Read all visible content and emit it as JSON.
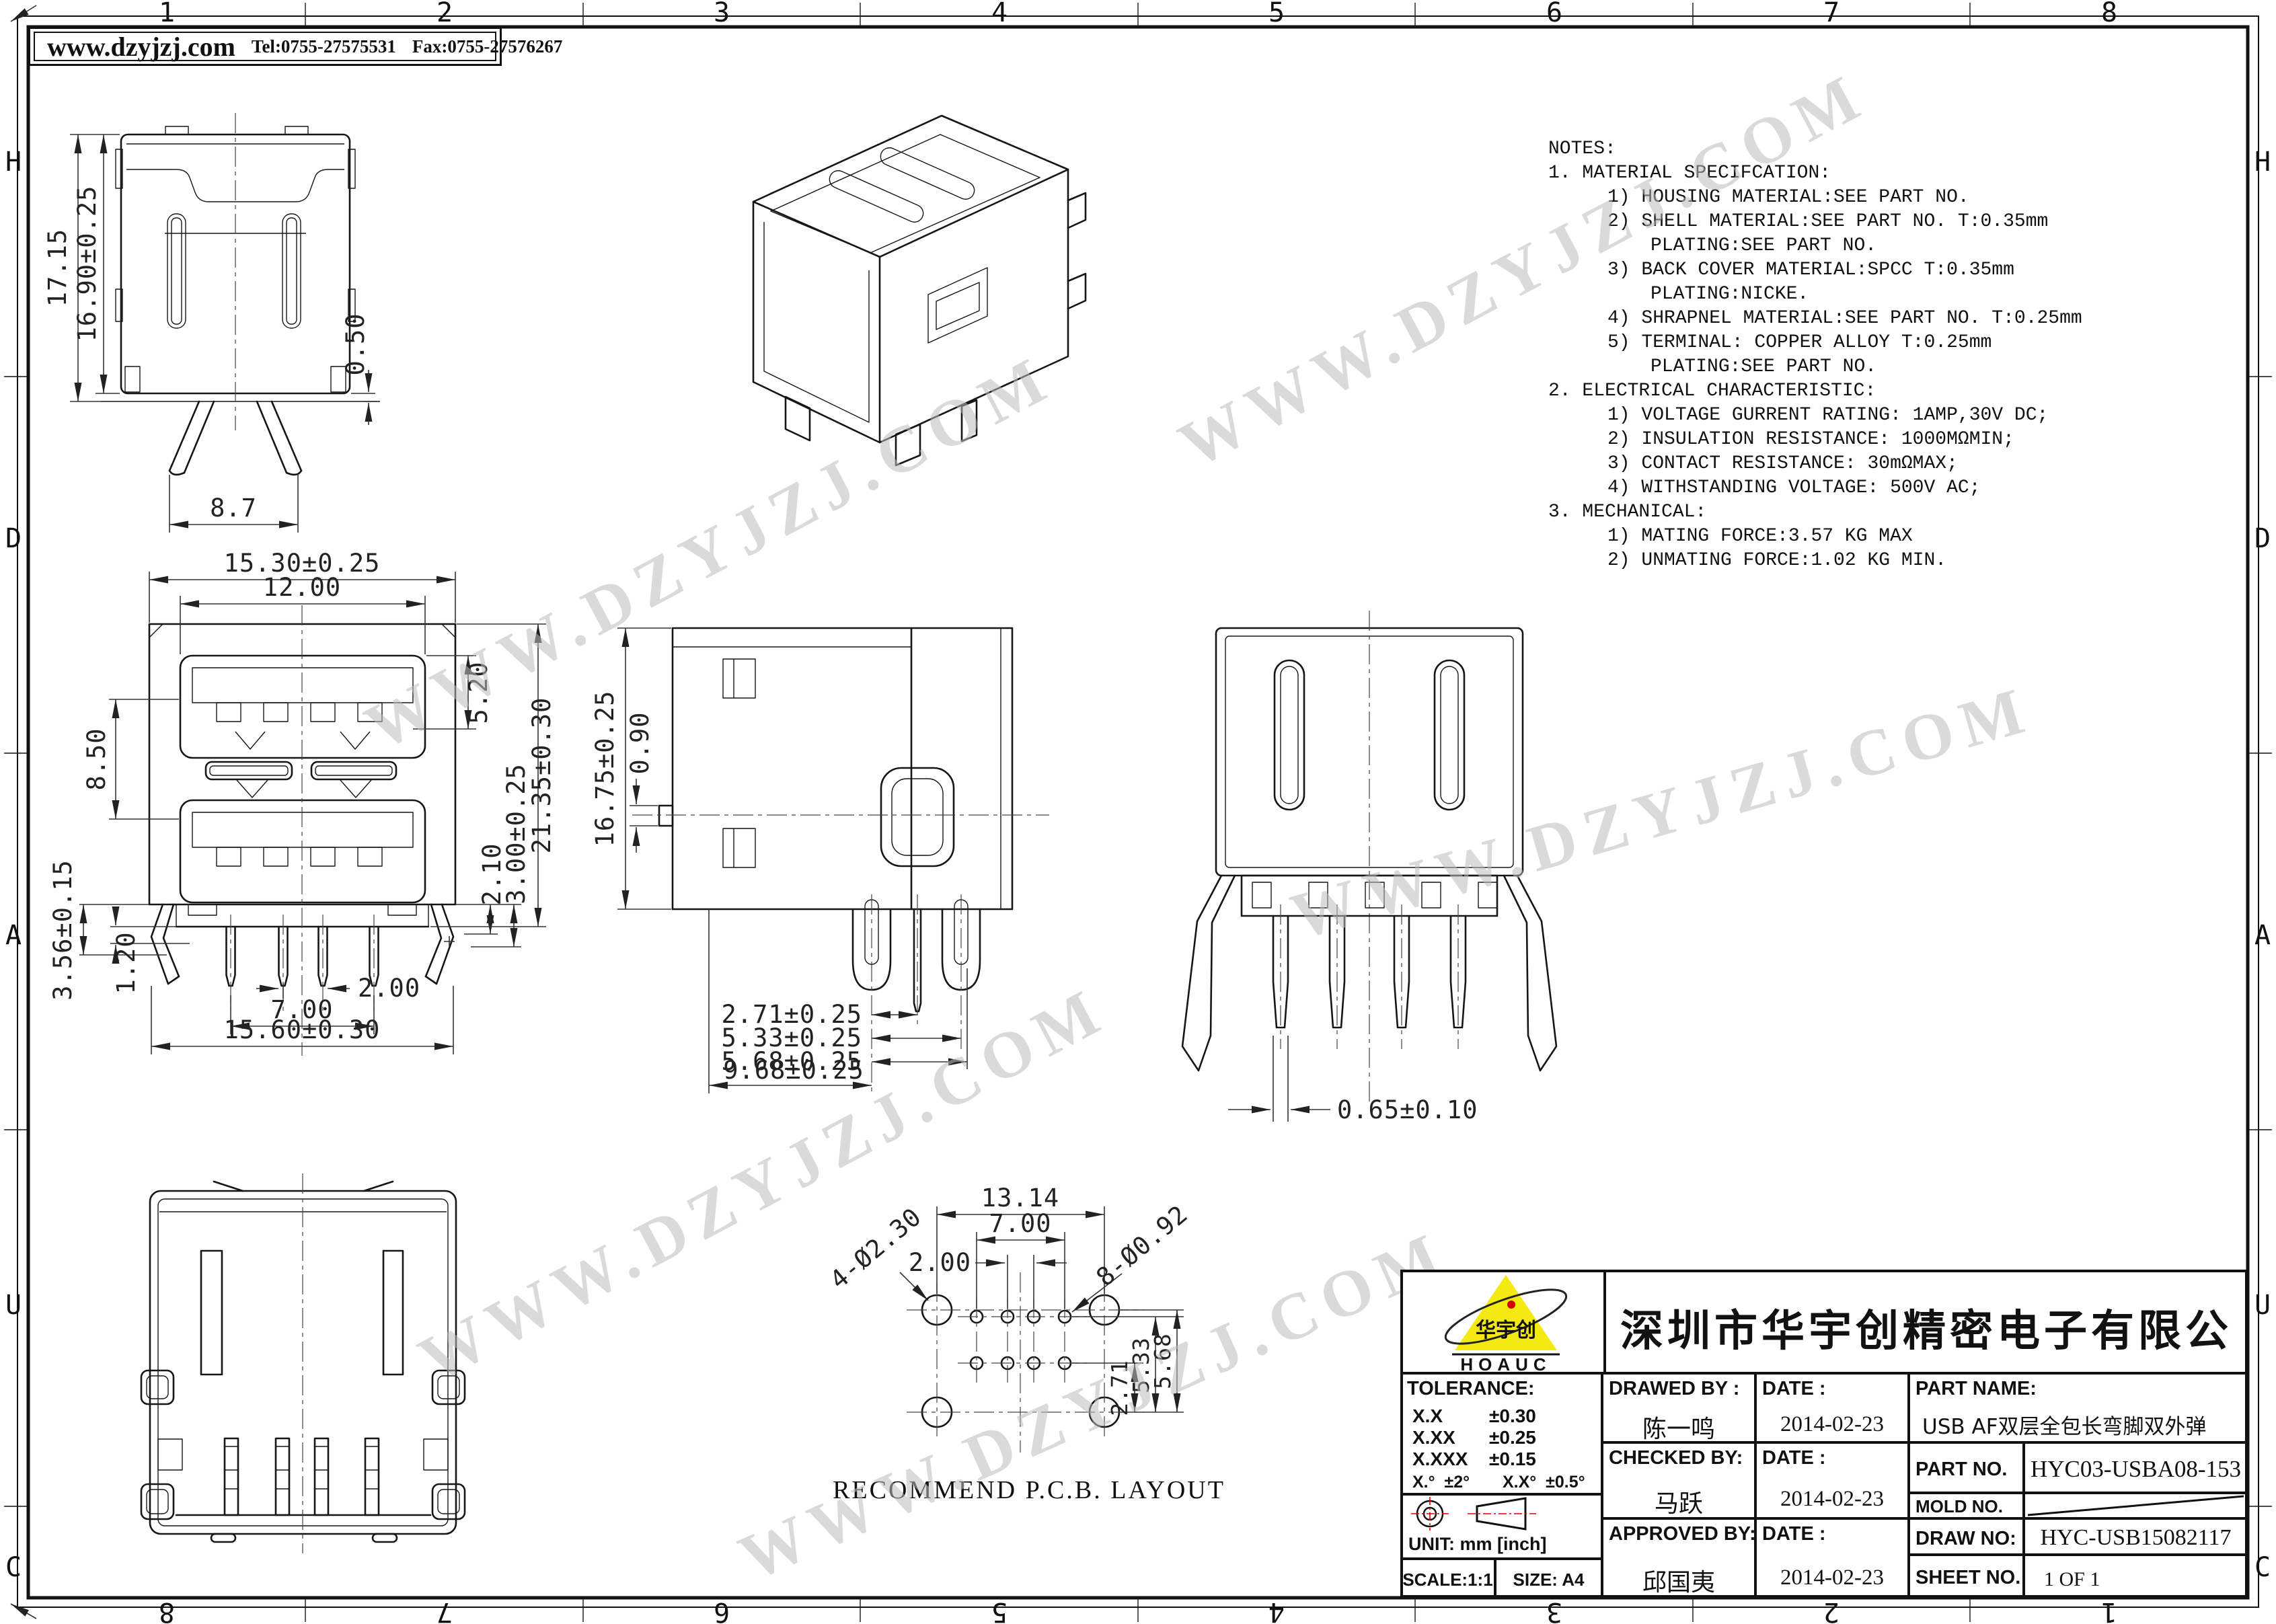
{
  "sheet": {
    "watermark": "WWW.DZYJZJ.COM",
    "zones_top": [
      "1",
      "2",
      "3",
      "4",
      "5",
      "6",
      "7",
      "8"
    ],
    "zones_bottom": [
      "8",
      "7",
      "6",
      "5",
      "4",
      "3",
      "2",
      "1"
    ],
    "zones_left": [
      "H",
      "D",
      "A",
      "U",
      "C"
    ],
    "zones_right": [
      "H",
      "D",
      "A",
      "U",
      "C"
    ]
  },
  "header": {
    "website": "www.dzyjzj.com",
    "tel": "Tel:0755-27575531",
    "fax": "Fax:0755-27576267"
  },
  "notes": {
    "title": "NOTES:",
    "lines": [
      {
        "t": "1. MATERIAL SPECIFCATION:"
      },
      {
        "t": "1) HOUSING MATERIAL:SEE PART NO."
      },
      {
        "t": "2) SHELL MATERIAL:SEE PART NO. T:0.35mm"
      },
      {
        "t": "PLATING:SEE PART NO."
      },
      {
        "t": "3) BACK COVER MATERIAL:SPCC T:0.35mm"
      },
      {
        "t": "PLATING:NICKE."
      },
      {
        "t": "4) SHRAPNEL MATERIAL:SEE PART NO. T:0.25mm"
      },
      {
        "t": "5) TERMINAL: COPPER ALLOY T:0.25mm"
      },
      {
        "t": "PLATING:SEE PART NO."
      },
      {
        "t": "2. ELECTRICAL CHARACTERISTIC:"
      },
      {
        "t": "1) VOLTAGE GURRENT RATING: 1AMP,30V DC;"
      },
      {
        "t": "2) INSULATION RESISTANCE: 1000MΩMIN;"
      },
      {
        "t": "3) CONTACT RESISTANCE: 30mΩMAX;"
      },
      {
        "t": "4) WITHSTANDING VOLTAGE: 500V AC;"
      },
      {
        "t": "3. MECHANICAL:"
      },
      {
        "t": "1) MATING FORCE:3.57 KG MAX"
      },
      {
        "t": "2) UNMATING FORCE:1.02 KG MIN."
      }
    ]
  },
  "views": {
    "front_top": {
      "h_total": "17.15",
      "h_shell": "16.90±0.25",
      "standoff": "0.50",
      "w_legs": "8.7"
    },
    "front_mid": {
      "w_shell": "15.30±0.25",
      "w_inner": "12.00",
      "h_port": "5.20",
      "h_pitch": "8.50",
      "h_total": "21.35±0.30",
      "d3": "3.00±0.25",
      "d21": "2.10",
      "d12": "1.20",
      "h_leg": "3.56±0.15",
      "pin_pitch": "2.00",
      "pin_span": "7.00",
      "w_total": "15.60±0.30",
      "plus": "+"
    },
    "side": {
      "h_total": "16.75±0.25",
      "tab": "0.90",
      "p1": "2.71±0.25",
      "p2": "5.33±0.25",
      "p3": "5.68±0.25",
      "p4": "9.68±0.25"
    },
    "rear": {
      "pin_w": "0.65±0.10"
    },
    "pcb": {
      "w_mount": "13.14",
      "pin_span": "7.00",
      "pin_pitch": "2.00",
      "mount_hole": "4-Ø2.30",
      "pin_hole": "8-Ø0.92",
      "r1": "2.71",
      "r2": "5.33",
      "r3": "5.68",
      "caption": "RECOMMEND P.C.B. LAYOUT"
    }
  },
  "title_block": {
    "company": "深圳市华宇创精密电子有限公司",
    "logo": {
      "text": "华宇创",
      "sub": "HOAUC"
    },
    "colors": {
      "logo_yellow": "#f5e914",
      "logo_red": "#d40000",
      "line_black": "#111111"
    },
    "tolerance": {
      "label": "TOLERANCE:",
      "r1k": "X.X",
      "r1v": "±0.30",
      "r2k": "X.XX",
      "r2v": "±0.25",
      "r3k": "X.XXX",
      "r3v": "±0.15",
      "ang1": "X.°  ±2°",
      "ang2": "X.X°  ±0.5°"
    },
    "unit_label": "UNIT:  mm  [inch]",
    "scale": "SCALE:1:1",
    "size": "SIZE:  A4",
    "drawed_label": "DRAWED BY :",
    "drawed_name": "陈一鸣",
    "drawed_date": "2014-02-23",
    "checked_label": "CHECKED BY:",
    "checked_name": "马跃",
    "checked_date": "2014-02-23",
    "approved_label": "APPROVED BY:",
    "approved_name": "邱国夷",
    "approved_date": "2014-02-23",
    "date_label": "DATE :",
    "part_name_label": "PART NAME:",
    "part_name": "USB AF双层全包长弯脚双外弹",
    "part_no_label": "PART NO.",
    "part_no": "HYC03-USBA08-153",
    "mold_no_label": "MOLD NO.",
    "draw_no_label": "DRAW NO:",
    "draw_no": "HYC-USB15082117",
    "sheet_no_label": "SHEET NO.",
    "sheet_no": "1 OF 1"
  }
}
